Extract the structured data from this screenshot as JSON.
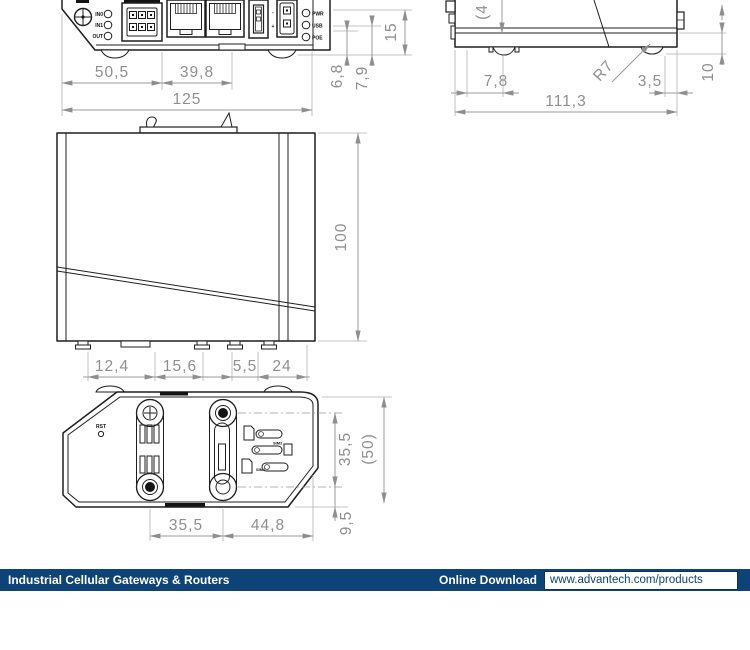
{
  "views": {
    "top": {
      "io_leds": [
        "IN0",
        "IN1",
        "OUT"
      ],
      "status_leds": [
        "PWR",
        "USB",
        "POE"
      ],
      "polarity": {
        "minus": "-",
        "plus": "+"
      },
      "dim_width_1": "50,5",
      "dim_width_2": "39,8",
      "dim_width_total": "125",
      "dim_h1": "6,8",
      "dim_h2": "7,9",
      "dim_h3": "15"
    },
    "side": {
      "dim_left": "7,8",
      "dim_right": "3,5",
      "dim_total": "111,3",
      "dim_radius": "R7",
      "dim_top_partial": "(4",
      "dim_height": "10"
    },
    "front": {
      "dim_height": "100",
      "dim_b1": "12,4",
      "dim_b2": "15,6",
      "dim_b3": "5,5",
      "dim_b4": "24"
    },
    "bottom": {
      "label_reset": "RST",
      "label_sim2": "SIM2",
      "label_sim1": "SIM1",
      "dim_w1": "35,5",
      "dim_w2": "44,8",
      "dim_h1": "35,5",
      "dim_h2": "(50)",
      "dim_h3": "9,5"
    }
  },
  "footer": {
    "title": "Industrial Cellular Gateways & Routers",
    "download_label": "Online Download",
    "url": "www.advantech.com/products",
    "bar_color": "#0e4377"
  }
}
